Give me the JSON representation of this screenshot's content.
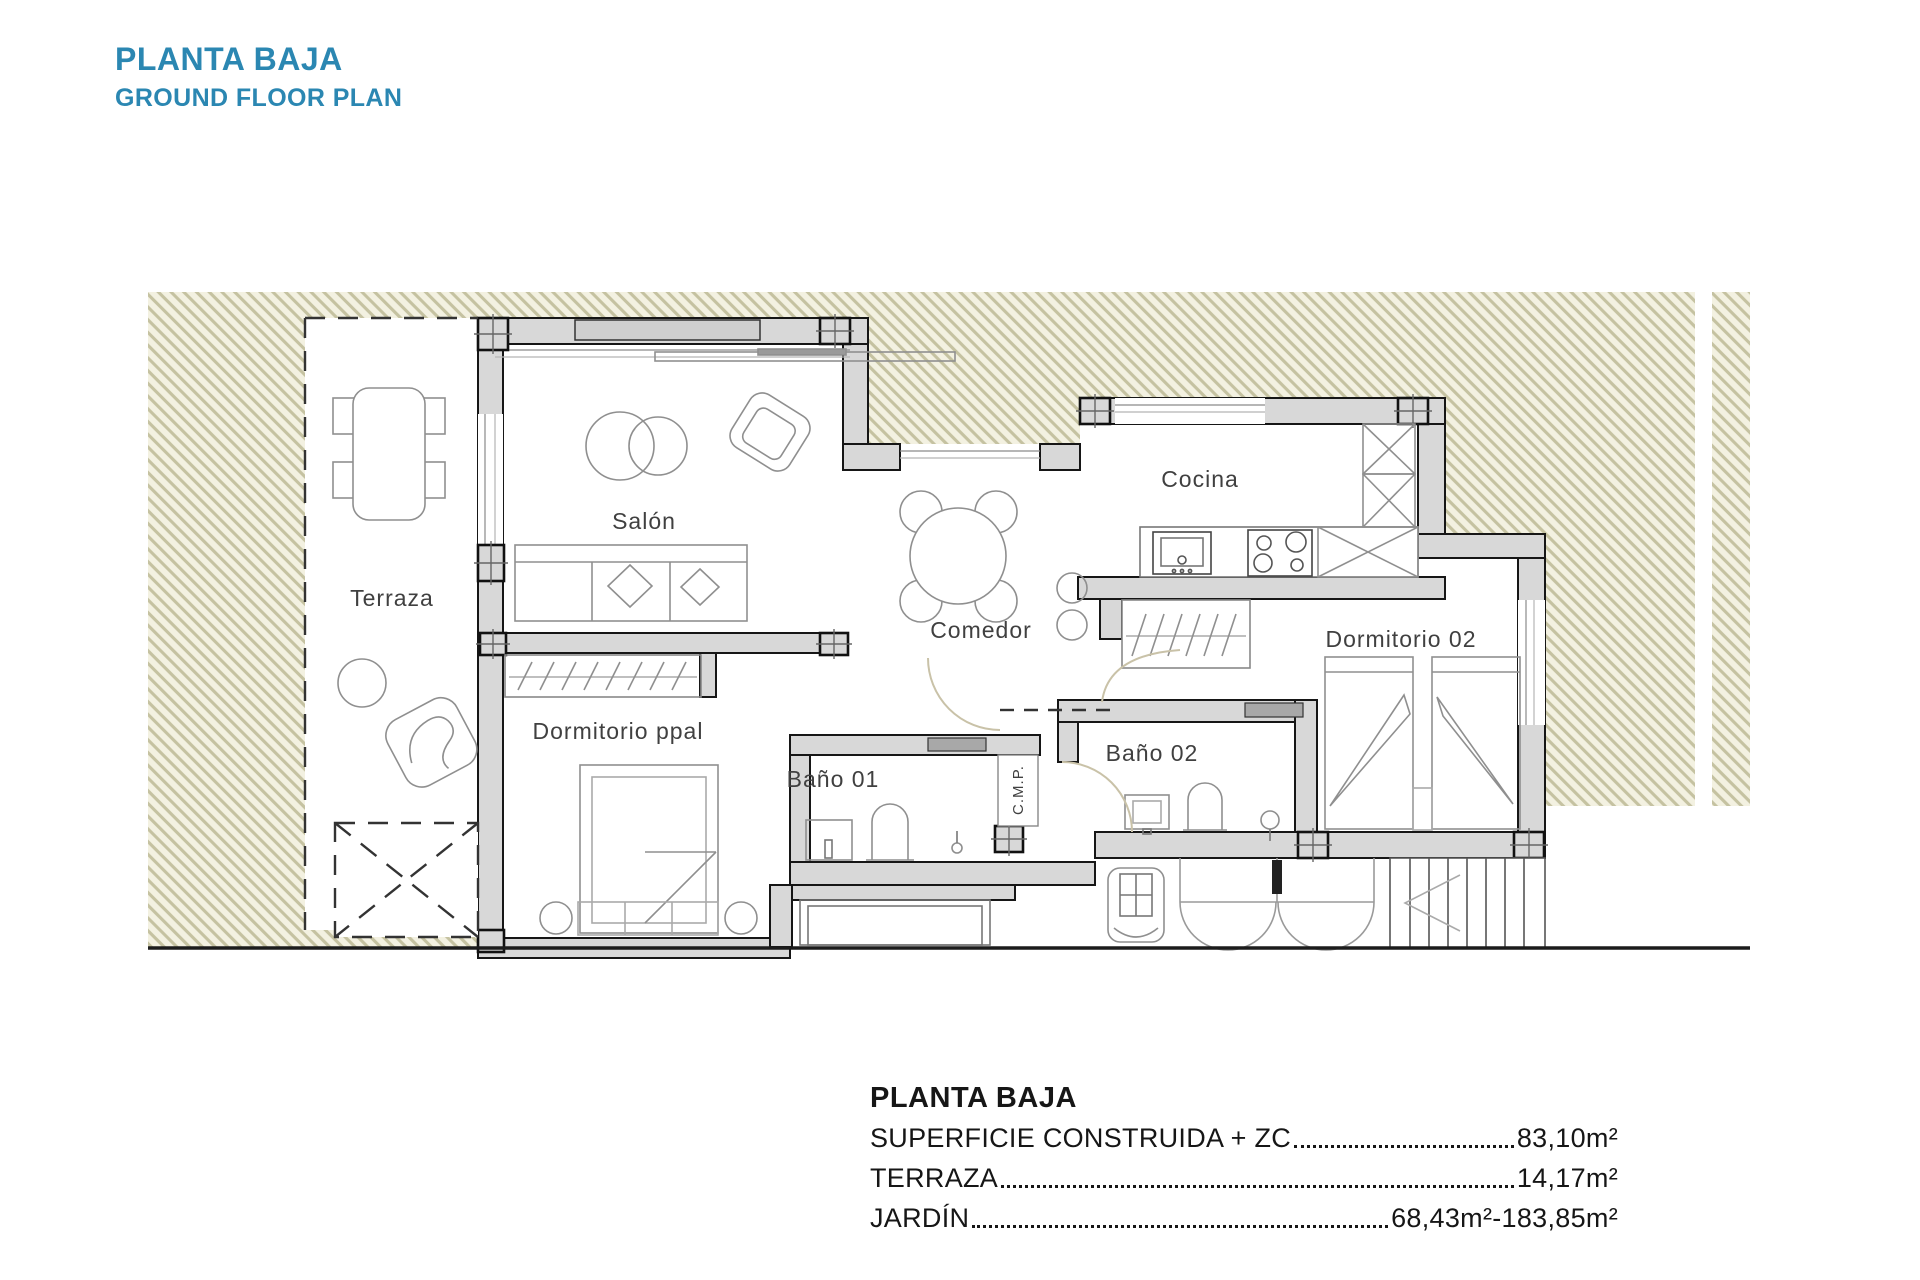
{
  "header": {
    "title_es": "PLANTA BAJA",
    "title_en": "GROUND FLOOR PLAN",
    "accent_color": "#2b87b2"
  },
  "plan": {
    "room_labels": {
      "terraza": "Terraza",
      "salon": "Salón",
      "comedor": "Comedor",
      "cocina": "Cocina",
      "dormitorio_ppal": "Dormitorio ppal",
      "bano_01": "Baño 01",
      "bano_02": "Baño 02",
      "dormitorio_02": "Dormitorio 02",
      "cmp": "C.M.P."
    },
    "colors": {
      "garden_fill": "#f3f1e1",
      "garden_hatch_line": "#c5c2a1",
      "wall_fill": "#d8d8d8",
      "wall_stroke": "#161616"
    }
  },
  "legend": {
    "title": "PLANTA BAJA",
    "rows": [
      {
        "label": "SUPERFICIE CONSTRUIDA + ZC",
        "value": "83,10m²"
      },
      {
        "label": "TERRAZA",
        "value": "14,17m²"
      },
      {
        "label": "JARDÍN",
        "value": "68,43m²-183,85m²"
      }
    ]
  }
}
